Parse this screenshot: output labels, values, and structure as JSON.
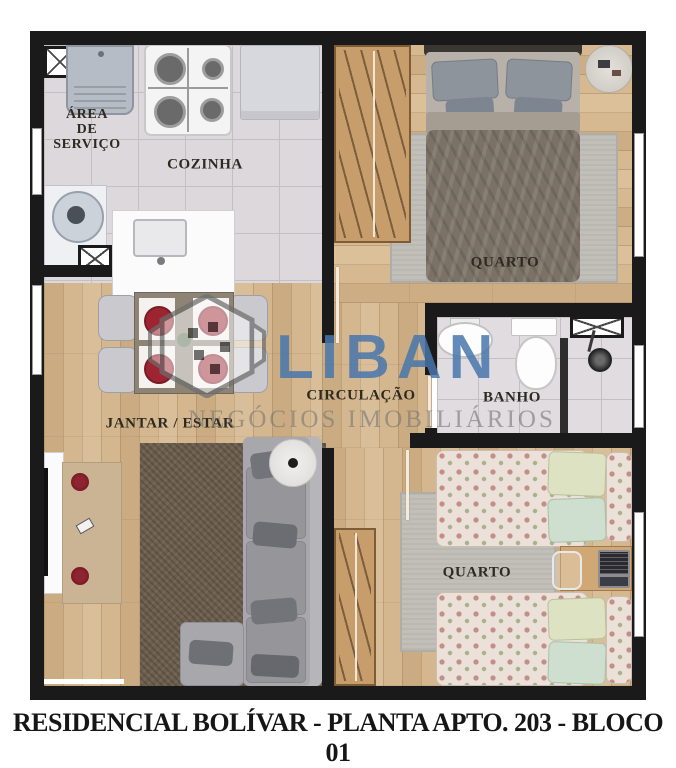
{
  "title": "RESIDENCIAL BOLÍVAR - PLANTA APTO. 203 - BLOCO 01",
  "watermark": {
    "brand": "LIBAN",
    "tagline": "NEGÓCIOS IMOBILIÁRIOS"
  },
  "rooms": {
    "service_area_line1": "ÁREA",
    "service_area_line2": "DE",
    "service_area_line3": "SERVIÇO",
    "kitchen": "COZINHA",
    "bedroom1": "QUARTO",
    "hallway": "CIRCULAÇÃO",
    "bathroom": "BANHO",
    "living_dining": "JANTAR / ESTAR",
    "bedroom2": "QUARTO"
  },
  "colors": {
    "wall": "#1a1a1a",
    "wood_floor": "#d4b78e",
    "tile_floor": "#dcd8db",
    "brand_blue": "#4c7bb1",
    "watermark_gray": "#8f8f8f",
    "label_text": "#2e2a22",
    "title_text": "#161616"
  }
}
